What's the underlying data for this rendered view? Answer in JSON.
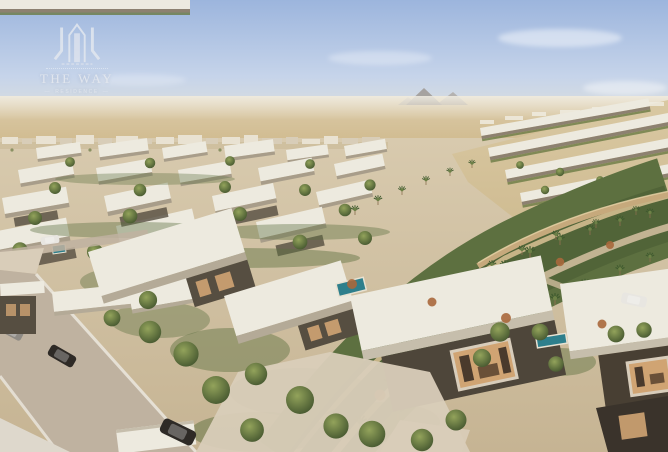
{
  "meta": {
    "title": "Aerial rendering of a desert villa compound: white flat-roofed villas, palm-lined green boulevard, terraced hillside homes, pyramids on the horizon"
  },
  "watermark": {
    "brand": "THE WAY",
    "tagline": "RESIDENCE",
    "divider": "—"
  },
  "palette": {
    "sky_top": "#9cb5dd",
    "sky_horizon": "#e3e2d8",
    "desert_far": "#d5c49e",
    "desert_warm": "#cfb98c",
    "city_light": "#e9e2d2",
    "roof_white": "#edeadf",
    "wall_dark": "#564e41",
    "window_warm": "#d0a473",
    "green_mid": "#5d7040",
    "green_dark": "#46572f",
    "rust": "#a8683c",
    "pool_teal": "#2e7f8c",
    "road_gray": "#bfb2a0",
    "path_light": "#d9cdb9",
    "wall_tan": "#c6a97c",
    "curb_white": "#e9e4da",
    "car_dark": "#2e2a26",
    "car_white": "#e8e6e1",
    "logo_color": "#e4e8ef"
  }
}
